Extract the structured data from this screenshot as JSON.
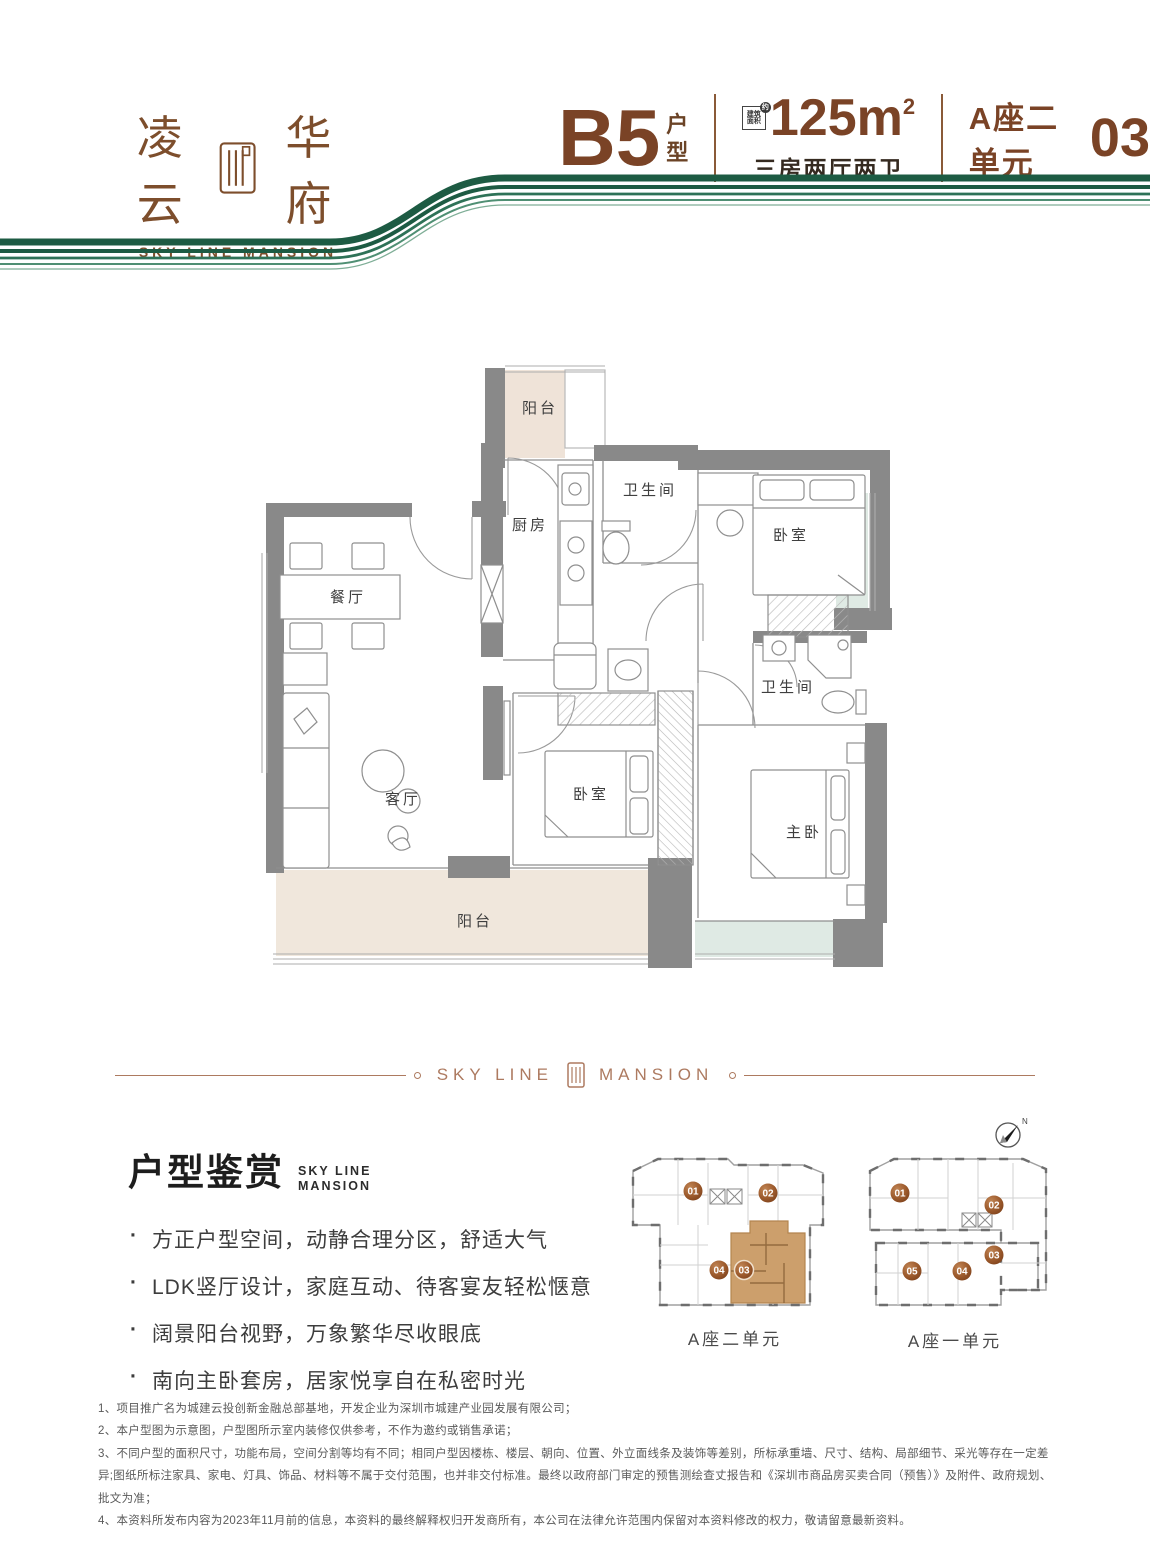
{
  "brand": {
    "logo_left": "凌云",
    "logo_right": "华府",
    "logo_en": "SKY LINE MANSION"
  },
  "header": {
    "plan_code": "B5",
    "plan_suffix_1": "户",
    "plan_suffix_2": "型",
    "area_badge_1": "建筑",
    "area_badge_2": "面积",
    "area_badge_circle": "约",
    "area_value": "125m",
    "area_exponent": "2",
    "layout_desc": "三房两厅两卫",
    "unit_block": "A座二单元",
    "unit_no": "03"
  },
  "floorplan": {
    "balcony_top": "阳台",
    "kitchen": "厨房",
    "bath_1": "卫生间",
    "bedroom_1": "卧室",
    "dining": "餐厅",
    "bath_2": "卫生间",
    "living": "客厅",
    "bedroom_2": "卧室",
    "master": "主卧",
    "balcony_bottom": "阳台"
  },
  "divider": {
    "left": "SKY LINE",
    "right": "MANSION"
  },
  "appreciation": {
    "title": "户型鉴赏",
    "sub1": "SKY LINE",
    "sub2": "MANSION",
    "bullets": [
      "方正户型空间，动静合理分区，舒适大气",
      "LDK竖厅设计，家庭互动、待客宴友轻松惬意",
      "阔景阳台视野，万象繁华尽收眼底",
      "南向主卧套房，居家悦享自在私密时光"
    ]
  },
  "keyplan": {
    "compass": "N",
    "left_building": {
      "label": "A座二单元",
      "units": [
        "01",
        "02",
        "04",
        "03"
      ],
      "highlighted_unit": "03"
    },
    "right_building": {
      "label": "A座一单元",
      "units": [
        "01",
        "02",
        "03",
        "05",
        "04"
      ]
    }
  },
  "disclaimer": [
    "1、项目推广名为城建云投创新金融总部基地，开发企业为深圳市城建产业园发展有限公司；",
    "2、本户型图为示意图，户型图所示室内装修仅供参考，不作为邀约或销售承诺；",
    "3、不同户型的面积尺寸，功能布局，空间分割等均有不同；相同户型因楼栋、楼层、朝向、位置、外立面线条及装饰等差别，所标承重墙、尺寸、结构、局部细节、采光等存在一定差异;图纸所标注家具、家电、灯具、饰品、材料等不属于交付范围，也并非交付标准。最终以政府部门审定的预售测绘查丈报告和《深圳市商品房买卖合同（预售）》及附件、政府规划、批文为准；",
    "4、本资料所发布内容为2023年11月前的信息，本资料的最终解释权归开发商所有，本公司在法律允许范围内保留对本资料修改的权力，敬请留意最新资料。"
  ],
  "colors": {
    "brand_brown": "#7a4326",
    "brand_green": "#1d5b43",
    "copper": "#ad7a60",
    "highlight_tan": "#cc9f6c",
    "wall_gray": "#898989",
    "balcony_beige": "#efe3d8",
    "bay_teal": "#dfeae4"
  }
}
